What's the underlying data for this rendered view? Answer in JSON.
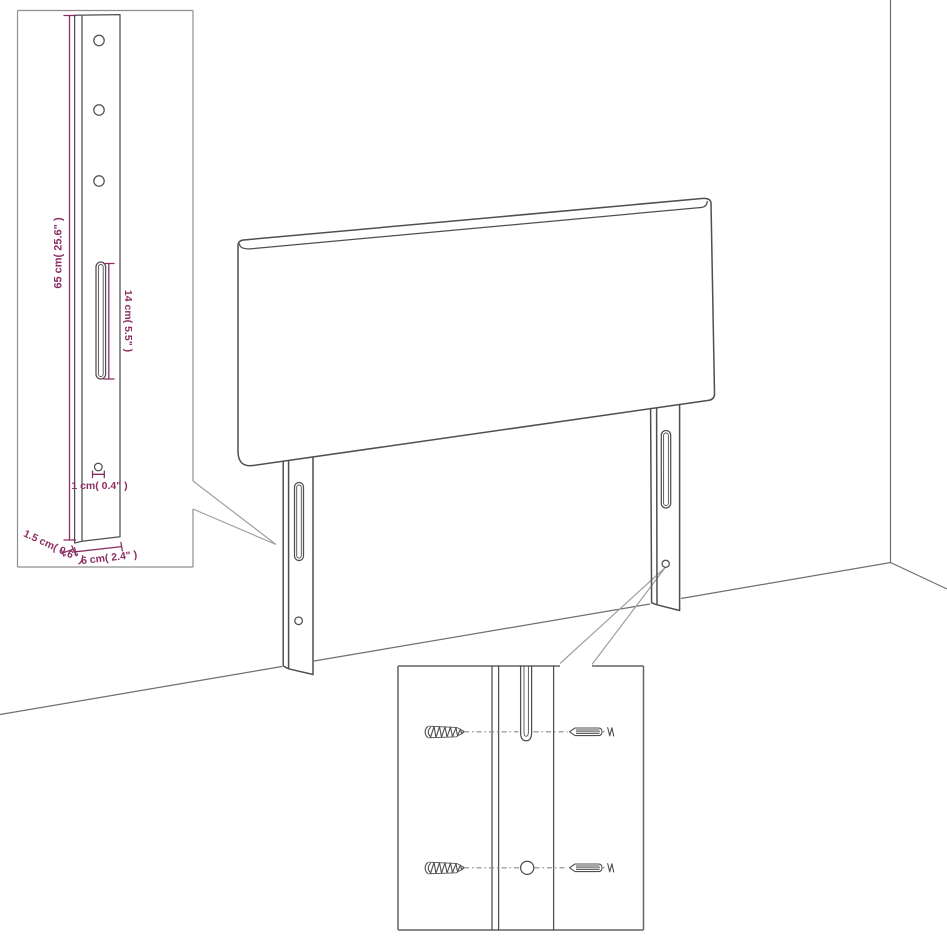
{
  "diagram_type": "headboard assembly dimension diagram",
  "colors": {
    "dimension_accent": "#8b2f63",
    "drawing_line": "#4f4f4f",
    "room_line": "#6f6f6f",
    "callout_line": "#9f9f9f",
    "background": "#ffffff"
  },
  "dimension_inset": {
    "leg_height": "65 cm( 25.6\" )",
    "slot_length": "14 cm( 5.5\" )",
    "hole_diameter": "1 cm( 0.4\" )",
    "side_thickness": "1.5 cm( 0.6\" )",
    "leg_width": "6 cm( 2.4\" )"
  },
  "hardware_inset": {
    "left_fastener": "screw",
    "right_fastener": "wall-plug"
  }
}
